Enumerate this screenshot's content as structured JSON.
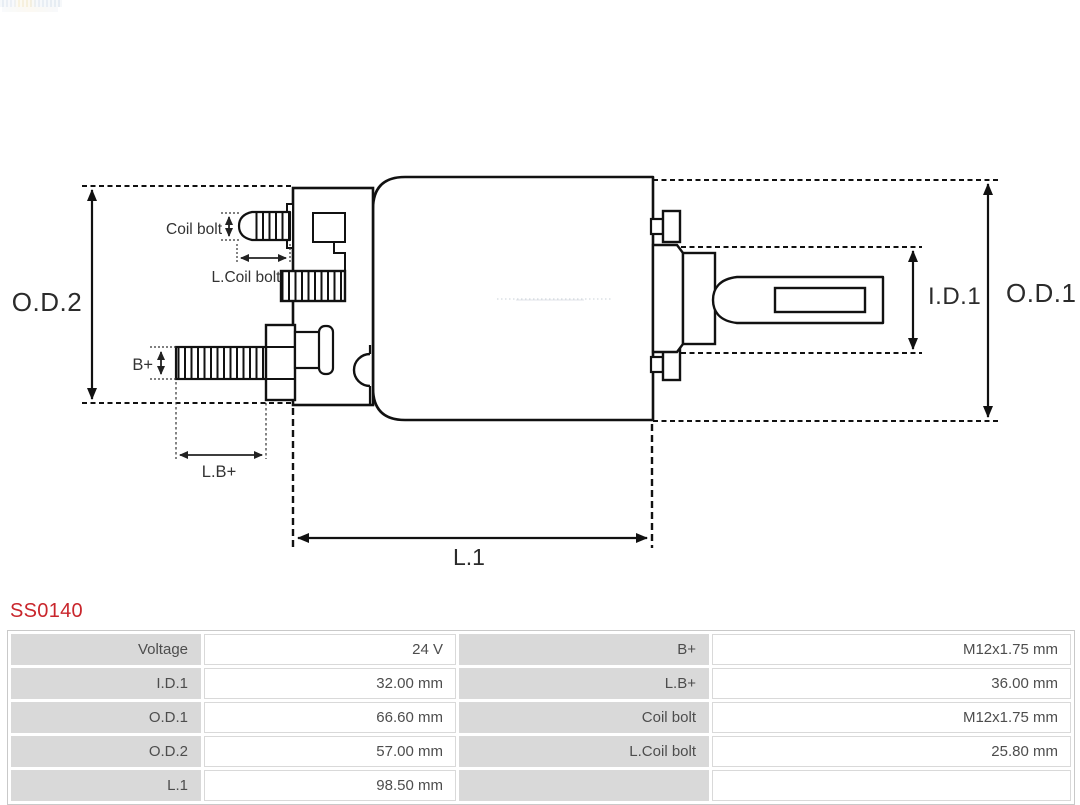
{
  "product": {
    "code": "SS0140",
    "code_color": "#c9262c"
  },
  "diagram": {
    "line_color": "#111111",
    "labels": {
      "od2": "O.D.2",
      "od1": "O.D.1",
      "id1": "I.D.1",
      "l1": "L.1",
      "coil_bolt": "Coil bolt",
      "l_coil_bolt": "L.Coil bolt",
      "b_plus": "B+",
      "l_b_plus": "L.B+"
    }
  },
  "spec_table": {
    "label_bg": "#d9d9d9",
    "value_bg": "#ffffff",
    "text_color": "#4d4d4d",
    "rows": [
      {
        "label1": "Voltage",
        "value1": "24 V",
        "label2": "B+",
        "value2": "M12x1.75 mm"
      },
      {
        "label1": "I.D.1",
        "value1": "32.00 mm",
        "label2": "L.B+",
        "value2": "36.00 mm"
      },
      {
        "label1": "O.D.1",
        "value1": "66.60 mm",
        "label2": "Coil bolt",
        "value2": "M12x1.75 mm"
      },
      {
        "label1": "O.D.2",
        "value1": "57.00 mm",
        "label2": "L.Coil bolt",
        "value2": "25.80 mm"
      },
      {
        "label1": "L.1",
        "value1": "98.50 mm",
        "label2": "",
        "value2": ""
      }
    ]
  }
}
